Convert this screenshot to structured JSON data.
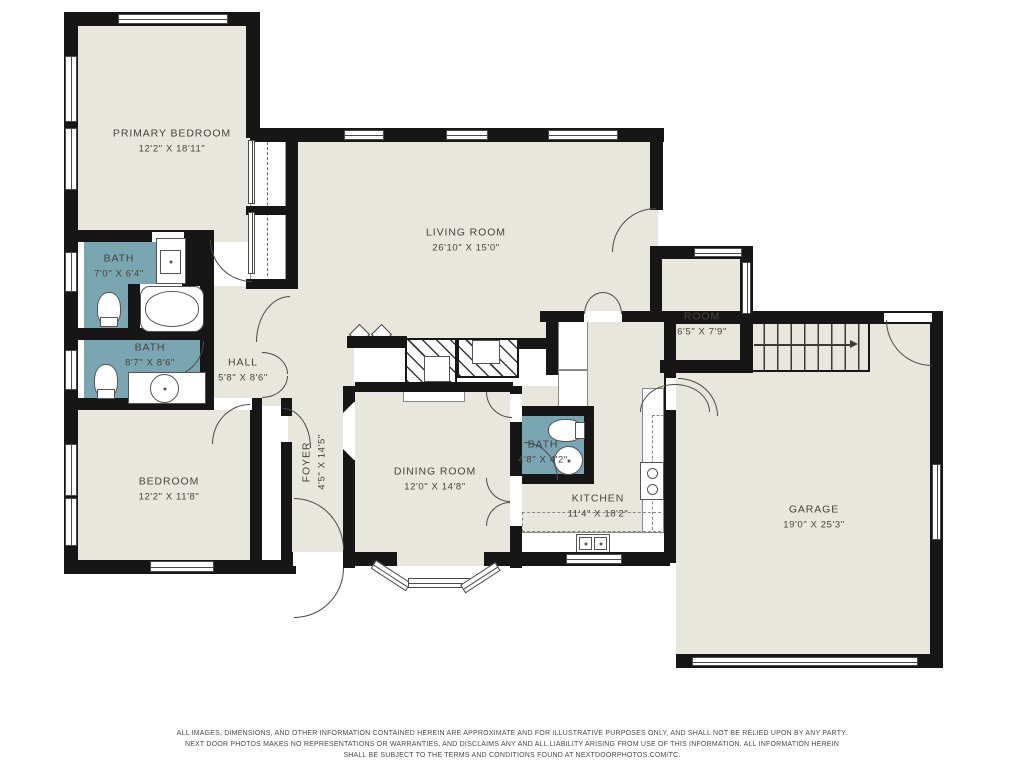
{
  "meta": {
    "width": 1024,
    "height": 768,
    "type": "residential-floor-plan"
  },
  "colors": {
    "floor": "#E8E7DE",
    "bath_fill": "#7AA6B1",
    "wall": "#161616",
    "background": "#FFFFFF",
    "label_text": "#44443E"
  },
  "rooms": {
    "primary_bedroom": {
      "name": "PRIMARY BEDROOM",
      "dims": "12'2\" X 18'11\""
    },
    "living_room": {
      "name": "LIVING ROOM",
      "dims": "26'10\" X 15'0\""
    },
    "bath_primary": {
      "name": "BATH",
      "dims": "7'0\" X 6'4\""
    },
    "bath_hall": {
      "name": "BATH",
      "dims": "8'7\" X 8'6\""
    },
    "hall": {
      "name": "HALL",
      "dims": "5'8\" X 8'6\""
    },
    "bedroom": {
      "name": "BEDROOM",
      "dims": "12'2\" X 11'8\""
    },
    "foyer": {
      "name": "FOYER",
      "dims": "4'5\" X 14'5\""
    },
    "dining_room": {
      "name": "DINING ROOM",
      "dims": "12'0\" X 14'8\""
    },
    "bath_small": {
      "name": "BATH",
      "dims": "4'8\" X 4'2\""
    },
    "kitchen": {
      "name": "KITCHEN",
      "dims": "11'4\" X 18'2\""
    },
    "room": {
      "name": "ROOM",
      "dims": "6'5\" X 7'9\""
    },
    "garage": {
      "name": "GARAGE",
      "dims": "19'0\" X 25'3\""
    }
  },
  "icons": [
    "bathtub-icon",
    "toilet-icon",
    "sink-icon",
    "stove-icon",
    "kitchen-sink-icon",
    "stairs-icon",
    "fireplace-icon",
    "door-arc-icon",
    "window-icon"
  ],
  "footer": {
    "line1": "ALL IMAGES, DIMENSIONS, AND OTHER INFORMATION CONTAINED HEREIN ARE APPROXIMATE AND FOR ILLUSTRATIVE PURPOSES ONLY, AND SHALL NOT BE RELIED UPON BY ANY PARTY.",
    "line2": "NEXT DOOR PHOTOS MAKES NO REPRESENTATIONS OR WARRANTIES, AND DISCLAIMS ANY AND ALL LIABILITY ARISING FROM USE OF THIS INFORMATION. ALL INFORMATION HEREIN",
    "line3": "SHALL BE SUBJECT TO THE TERMS AND CONDITIONS FOUND AT NEXTDOORPHOTOS.COM/TC."
  }
}
